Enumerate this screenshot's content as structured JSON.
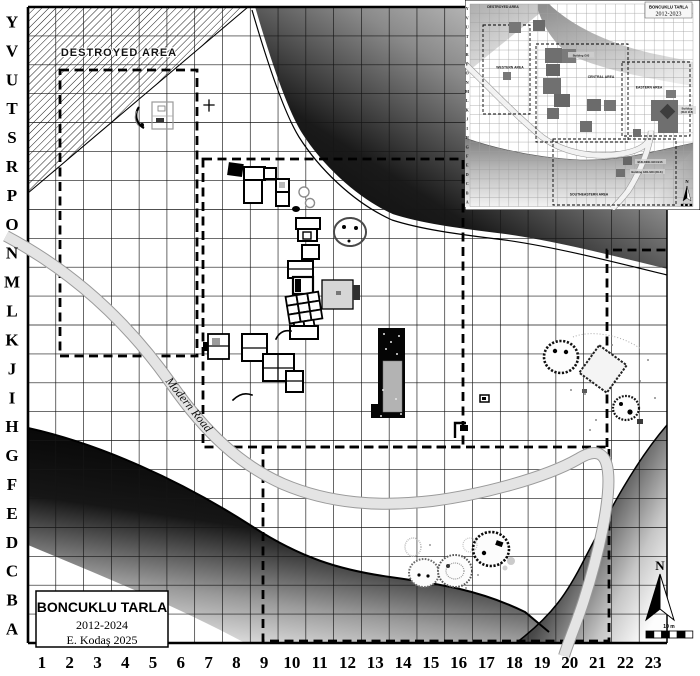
{
  "map": {
    "row_labels": [
      "Y",
      "V",
      "U",
      "T",
      "S",
      "R",
      "P",
      "O",
      "N",
      "M",
      "L",
      "K",
      "J",
      "I",
      "H",
      "G",
      "F",
      "E",
      "D",
      "C",
      "B",
      "A"
    ],
    "col_labels": [
      "1",
      "2",
      "3",
      "4",
      "5",
      "6",
      "7",
      "8",
      "9",
      "10",
      "11",
      "12",
      "13",
      "14",
      "15",
      "16",
      "17",
      "18",
      "19",
      "20",
      "21",
      "22",
      "23"
    ],
    "destroyed_area_label": "DESTROYED AREA",
    "road_label": "Modern Road",
    "north_label": "N",
    "scale_label": "10 m",
    "title_box": {
      "title": "BONCUKLU TARLA",
      "years": "2012-2024",
      "credit": "E. Kodaş 2025"
    }
  },
  "inset": {
    "title": "BONCUKLU TARLA",
    "years": "2012-2023",
    "row_labels": [
      "Y",
      "V",
      "U",
      "T",
      "S",
      "R",
      "P",
      "O",
      "N",
      "M",
      "L",
      "K",
      "J",
      "I",
      "H",
      "G",
      "F",
      "E",
      "D",
      "C",
      "B",
      "A"
    ],
    "area_labels": {
      "destroyed": "DESTROYED AREA",
      "western": "WESTERN AREA",
      "central": "CENTRAL AREA",
      "eastern": "EASTERN AREA",
      "southeastern": "SOUTHEASTERN AREA"
    },
    "building_labels": {
      "central": "Building G93",
      "east_line1": "Building",
      "east_line2": "(DLK B-8)",
      "south_1": "BUILDING GD4 B16",
      "south_2": "Building GD1-SD4 (DLK)"
    },
    "north_label": "N"
  },
  "colors": {
    "ink": "#000000",
    "road_fill": "#e4e4e4",
    "structure_fill": "#d6d6d6",
    "excavation_square": "#6f6f6f"
  }
}
